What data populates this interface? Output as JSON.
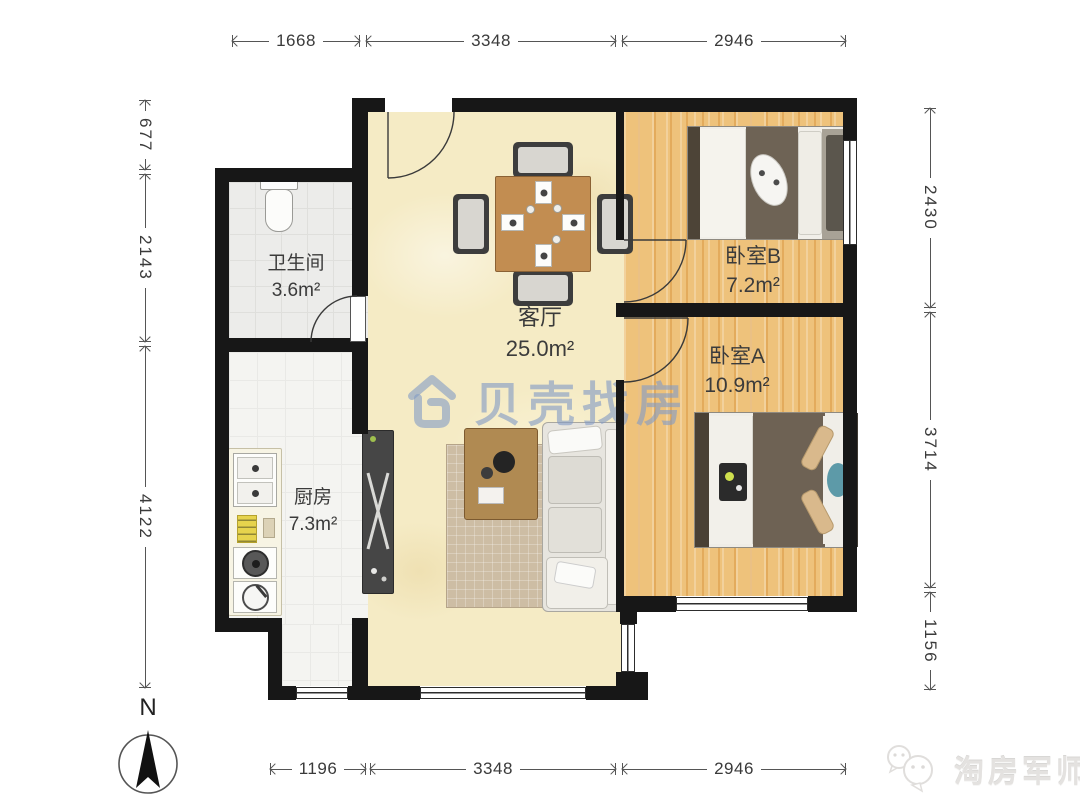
{
  "dims": {
    "top": [
      "1668",
      "3348",
      "2946"
    ],
    "bottom": [
      "1196",
      "3348",
      "2946"
    ],
    "left": [
      "677",
      "2143",
      "4122"
    ],
    "right": [
      "2430",
      "3714",
      "1156"
    ]
  },
  "rooms": {
    "bathroom": {
      "name": "卫生间",
      "area": "3.6m²"
    },
    "kitchen": {
      "name": "厨房",
      "area": "7.3m²"
    },
    "living": {
      "name": "客厅",
      "area": "25.0m²"
    },
    "bedroomB": {
      "name": "卧室B",
      "area": "7.2m²"
    },
    "bedroomA": {
      "name": "卧室A",
      "area": "10.9m²"
    }
  },
  "compass": {
    "label": "N"
  },
  "watermarks": {
    "center": {
      "text": "贝壳找房"
    },
    "corner": {
      "text": "淘房军师"
    }
  },
  "colors": {
    "wall": "#171717",
    "wood_floor": "#ecba6e",
    "living_floor": "#f5ebc5",
    "watermark_blue": "#82a0c9",
    "dim_text": "#3a3a3a"
  }
}
